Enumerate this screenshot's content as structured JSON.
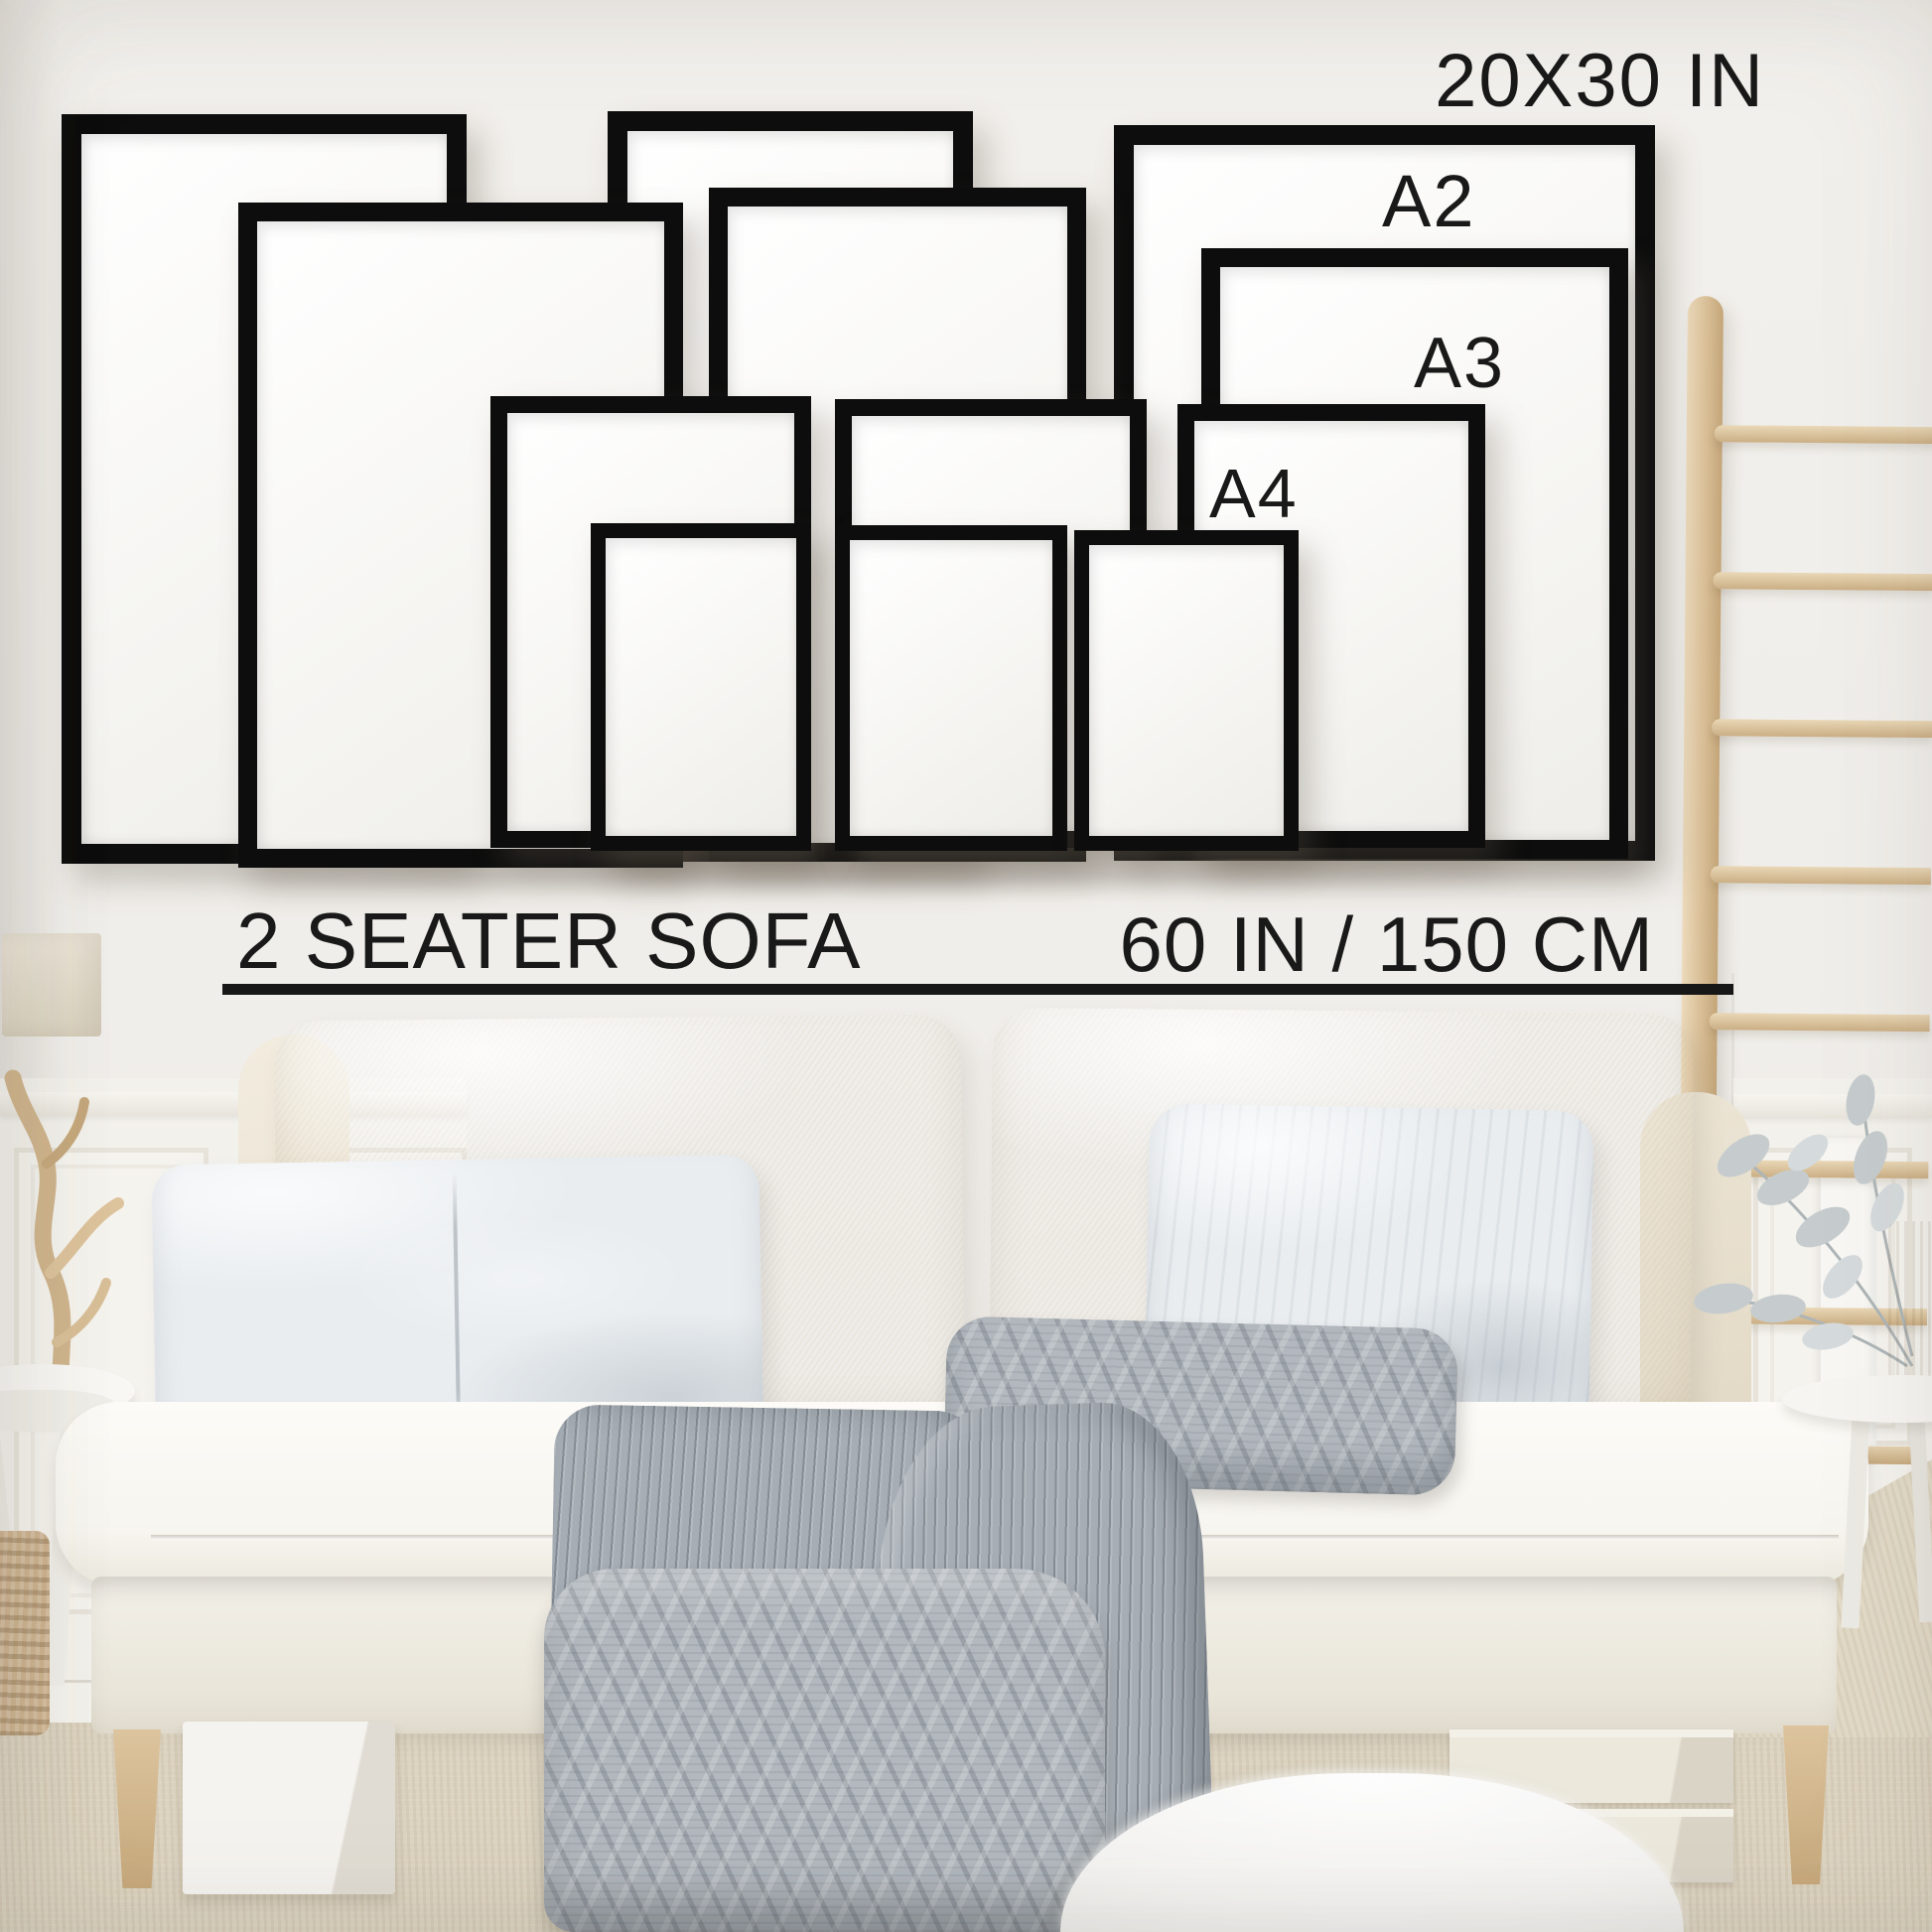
{
  "labels": {
    "size_20x30": "20X30 IN",
    "size_a2": "A2",
    "size_a3": "A3",
    "size_a4": "A4"
  },
  "caption": {
    "sofa": "2 SEATER SOFA",
    "width": "60 IN / 150 CM"
  },
  "frames": [
    {
      "size": "20X30 IN",
      "count": 3,
      "row": "back"
    },
    {
      "size": "A2",
      "count": 3,
      "row": "middle-back"
    },
    {
      "size": "A3",
      "count": 3,
      "row": "middle-front"
    },
    {
      "size": "A4",
      "count": 3,
      "row": "front"
    }
  ],
  "colors": {
    "frame_black": "#0d0d0d",
    "text": "#1a1a1a",
    "wall": "#f0eeea",
    "sofa_cream": "#f6f3ea",
    "pillow_gray": "#e9edf0",
    "throw_gray": "#b2b8be",
    "carpet_beige": "#dcd3c0",
    "wood_light": "#dcc6a4"
  }
}
